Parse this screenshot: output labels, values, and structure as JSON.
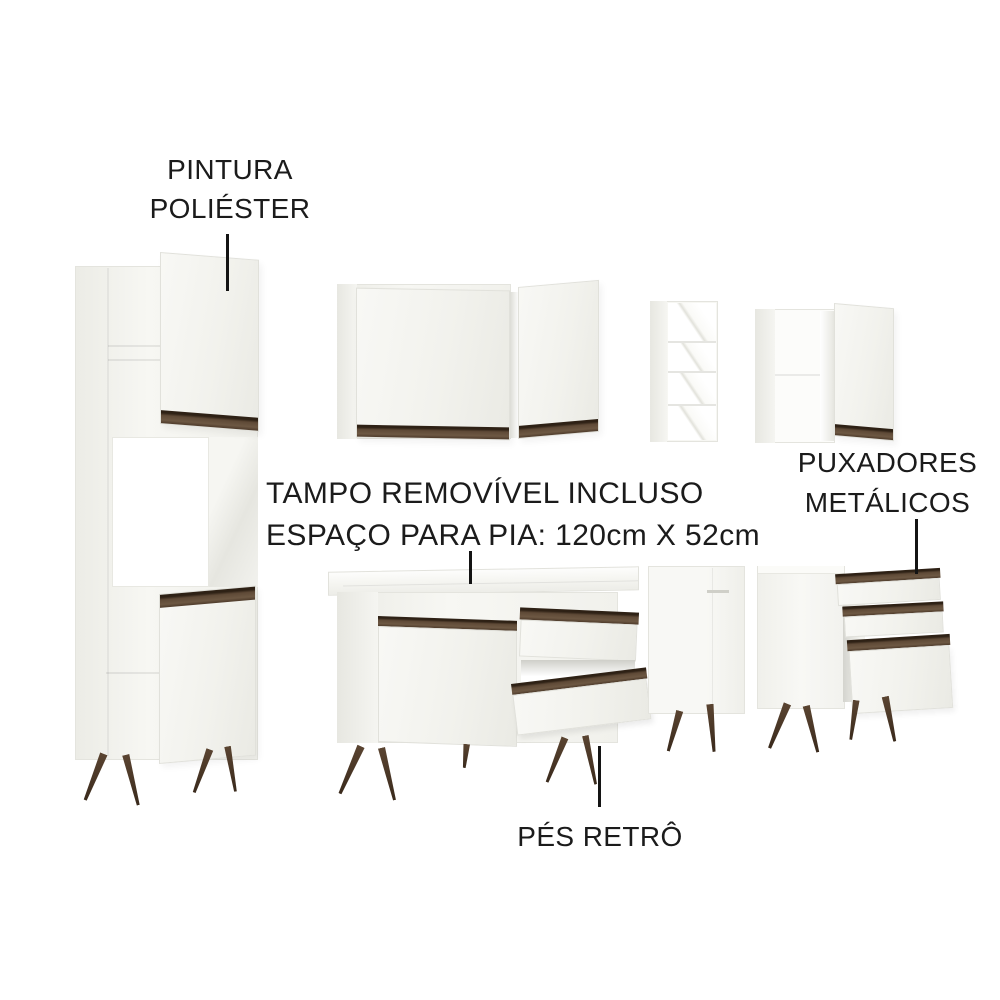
{
  "annotations": {
    "paint": {
      "line1": "PINTURA",
      "line2": "POLIÉSTER"
    },
    "countertop": {
      "line1": "TAMPO REMOVÍVEL INCLUSO",
      "line2": "ESPAÇO PARA PIA: 120cm X 52cm"
    },
    "handles": {
      "line1": "PUXADORES",
      "line2": "METÁLICOS"
    },
    "feet": {
      "line1": "PÉS RETRÔ"
    }
  },
  "colors": {
    "background": "#ffffff",
    "cabinet_white": "#f4f4f0",
    "handle_brown": "#5f4a37",
    "leg_brown": "#4b3727",
    "annotation_text": "#1b1b1b",
    "pointer_black": "#141414"
  }
}
